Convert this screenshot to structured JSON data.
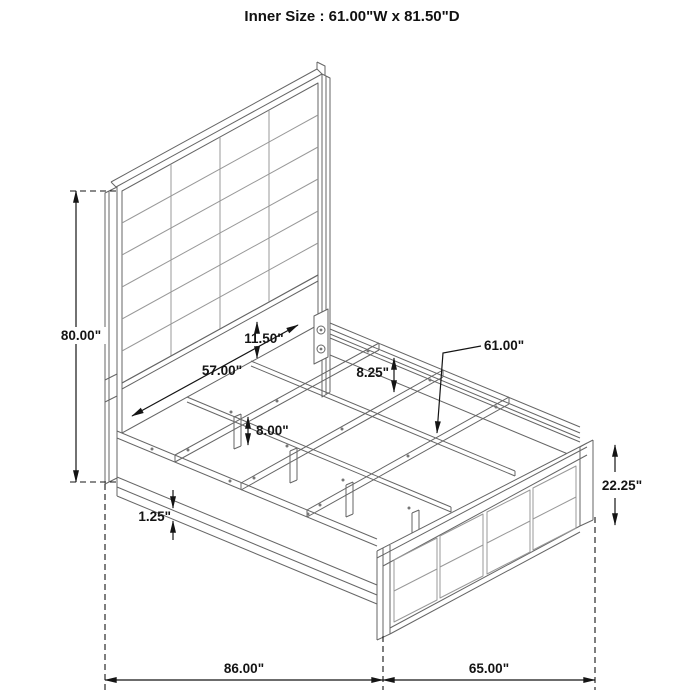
{
  "title": "Inner Size : 61.00\"W x 81.50\"D",
  "dims": {
    "headboard_height": "80.00\"",
    "headboard_inner_width": "57.00\"",
    "headboard_panel_to_rail": "11.50\"",
    "rail_to_slat": "8.25\"",
    "slat_length": "61.00\"",
    "support_leg_height": "8.00\"",
    "rail_bottom_lip": "1.25\"",
    "footboard_height": "22.25\"",
    "overall_depth": "86.00\"",
    "footboard_width": "65.00\""
  }
}
